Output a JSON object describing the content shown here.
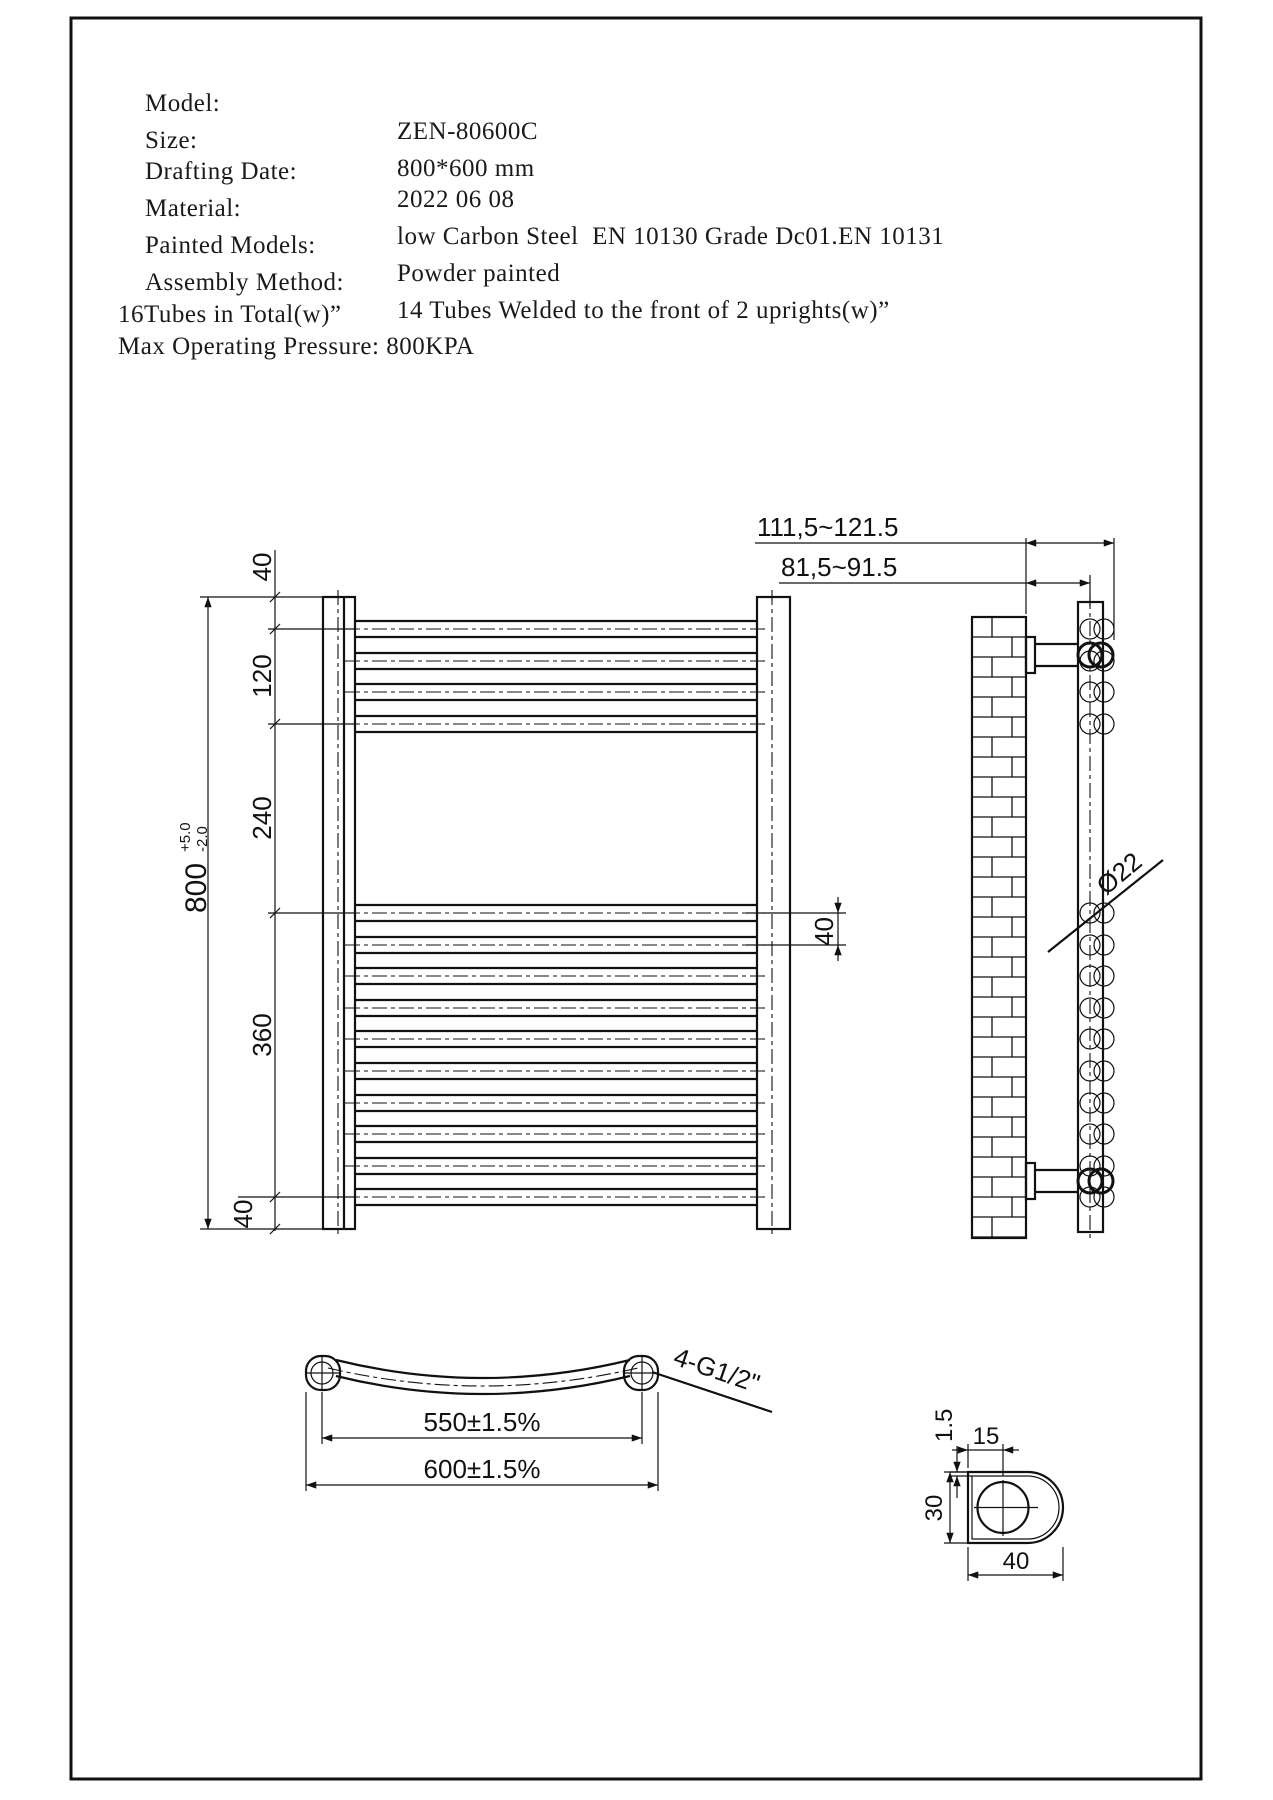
{
  "colors": {
    "ink": "#111111",
    "paper": "#ffffff"
  },
  "header": {
    "rows": [
      {
        "label": "Model:",
        "value": "ZEN-80600C"
      },
      {
        "label": "Size:",
        "value": "800*600 mm"
      },
      {
        "label": "Drafting Date:",
        "value": "2022 06 08"
      },
      {
        "label": "Material:",
        "value": "low Carbon Steel  EN 10130 Grade Dc01.EN 10131"
      },
      {
        "label": "Painted Models:",
        "value": "Powder painted"
      },
      {
        "label": "Assembly Method:",
        "value": "14 Tubes Welded to the front of 2 uprights(w)”"
      }
    ],
    "extra_lines": [
      "16Tubes in Total(w)”",
      "Max Operating Pressure: 800KPA"
    ]
  },
  "front_view": {
    "segments": {
      "top": "40",
      "upper": "120",
      "middle": "240",
      "lower": "360",
      "bottom": "40"
    },
    "overall": {
      "value": "800",
      "tol_plus": "+5.0",
      "tol_minus": "-2.0"
    },
    "pitch": "40"
  },
  "side_view": {
    "mount_depth_outer": "111,5~121.5",
    "mount_depth_inner": "81,5~91.5",
    "tube_diameter": "Ø22"
  },
  "plan_view": {
    "tube_centres": "550±1.5%",
    "overall_width": "600±1.5%",
    "connections": "4-G1/2\""
  },
  "detail_view": {
    "thickness": "1.5",
    "tube_offset": "15",
    "profile_depth": "30",
    "profile_width": "40"
  }
}
